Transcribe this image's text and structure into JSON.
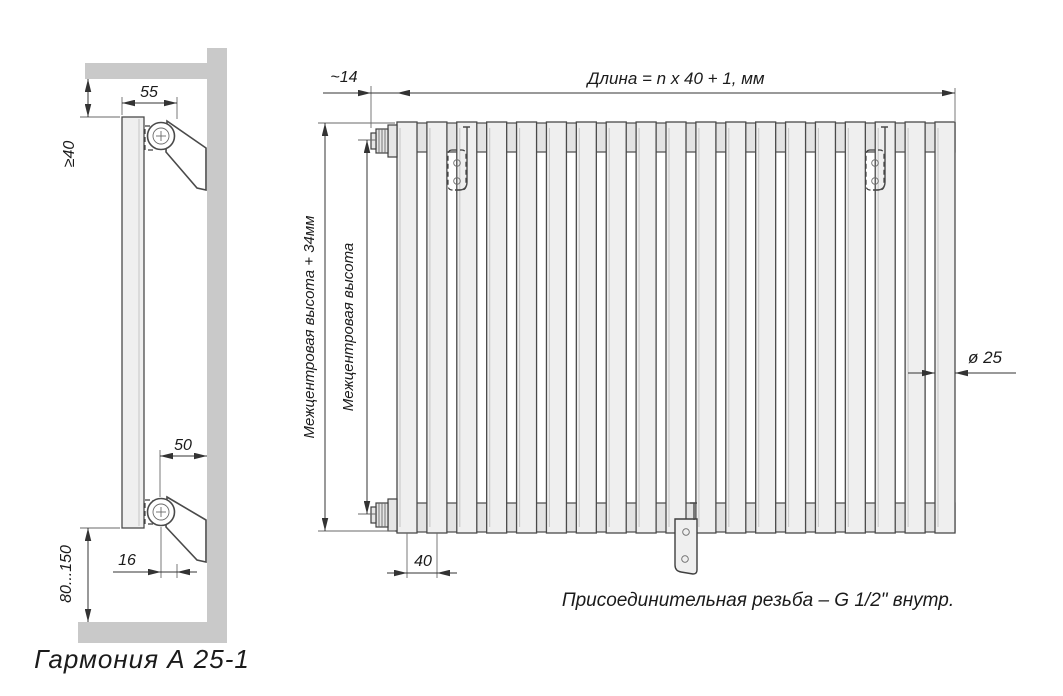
{
  "drawing": {
    "caption": "Гармония  А 25-1",
    "front_view": {
      "tube_count": 19,
      "labels": {
        "length_formula": "Длина = n x 40 + 1, мм",
        "end_offset": "~14",
        "height_outer": "Межцентровая высота + 34мм",
        "height_inner": "Межцентровая высота",
        "tube_pitch": "40",
        "tube_diameter": "ø 25",
        "thread_note": "Присоединительная резьба – G 1/2\" внутр."
      }
    },
    "side_view": {
      "labels": {
        "bracket_top_offset": "55",
        "wall_clearance": "≥40",
        "bracket_bottom_offset": "50",
        "hook_offset": "16",
        "floor_clearance": "80...150"
      }
    },
    "colors": {
      "wall": "#c9c9c9",
      "line": "#4a4a4a",
      "tube_fill": "#efefef",
      "header_fill": "#e3e3e3"
    }
  }
}
